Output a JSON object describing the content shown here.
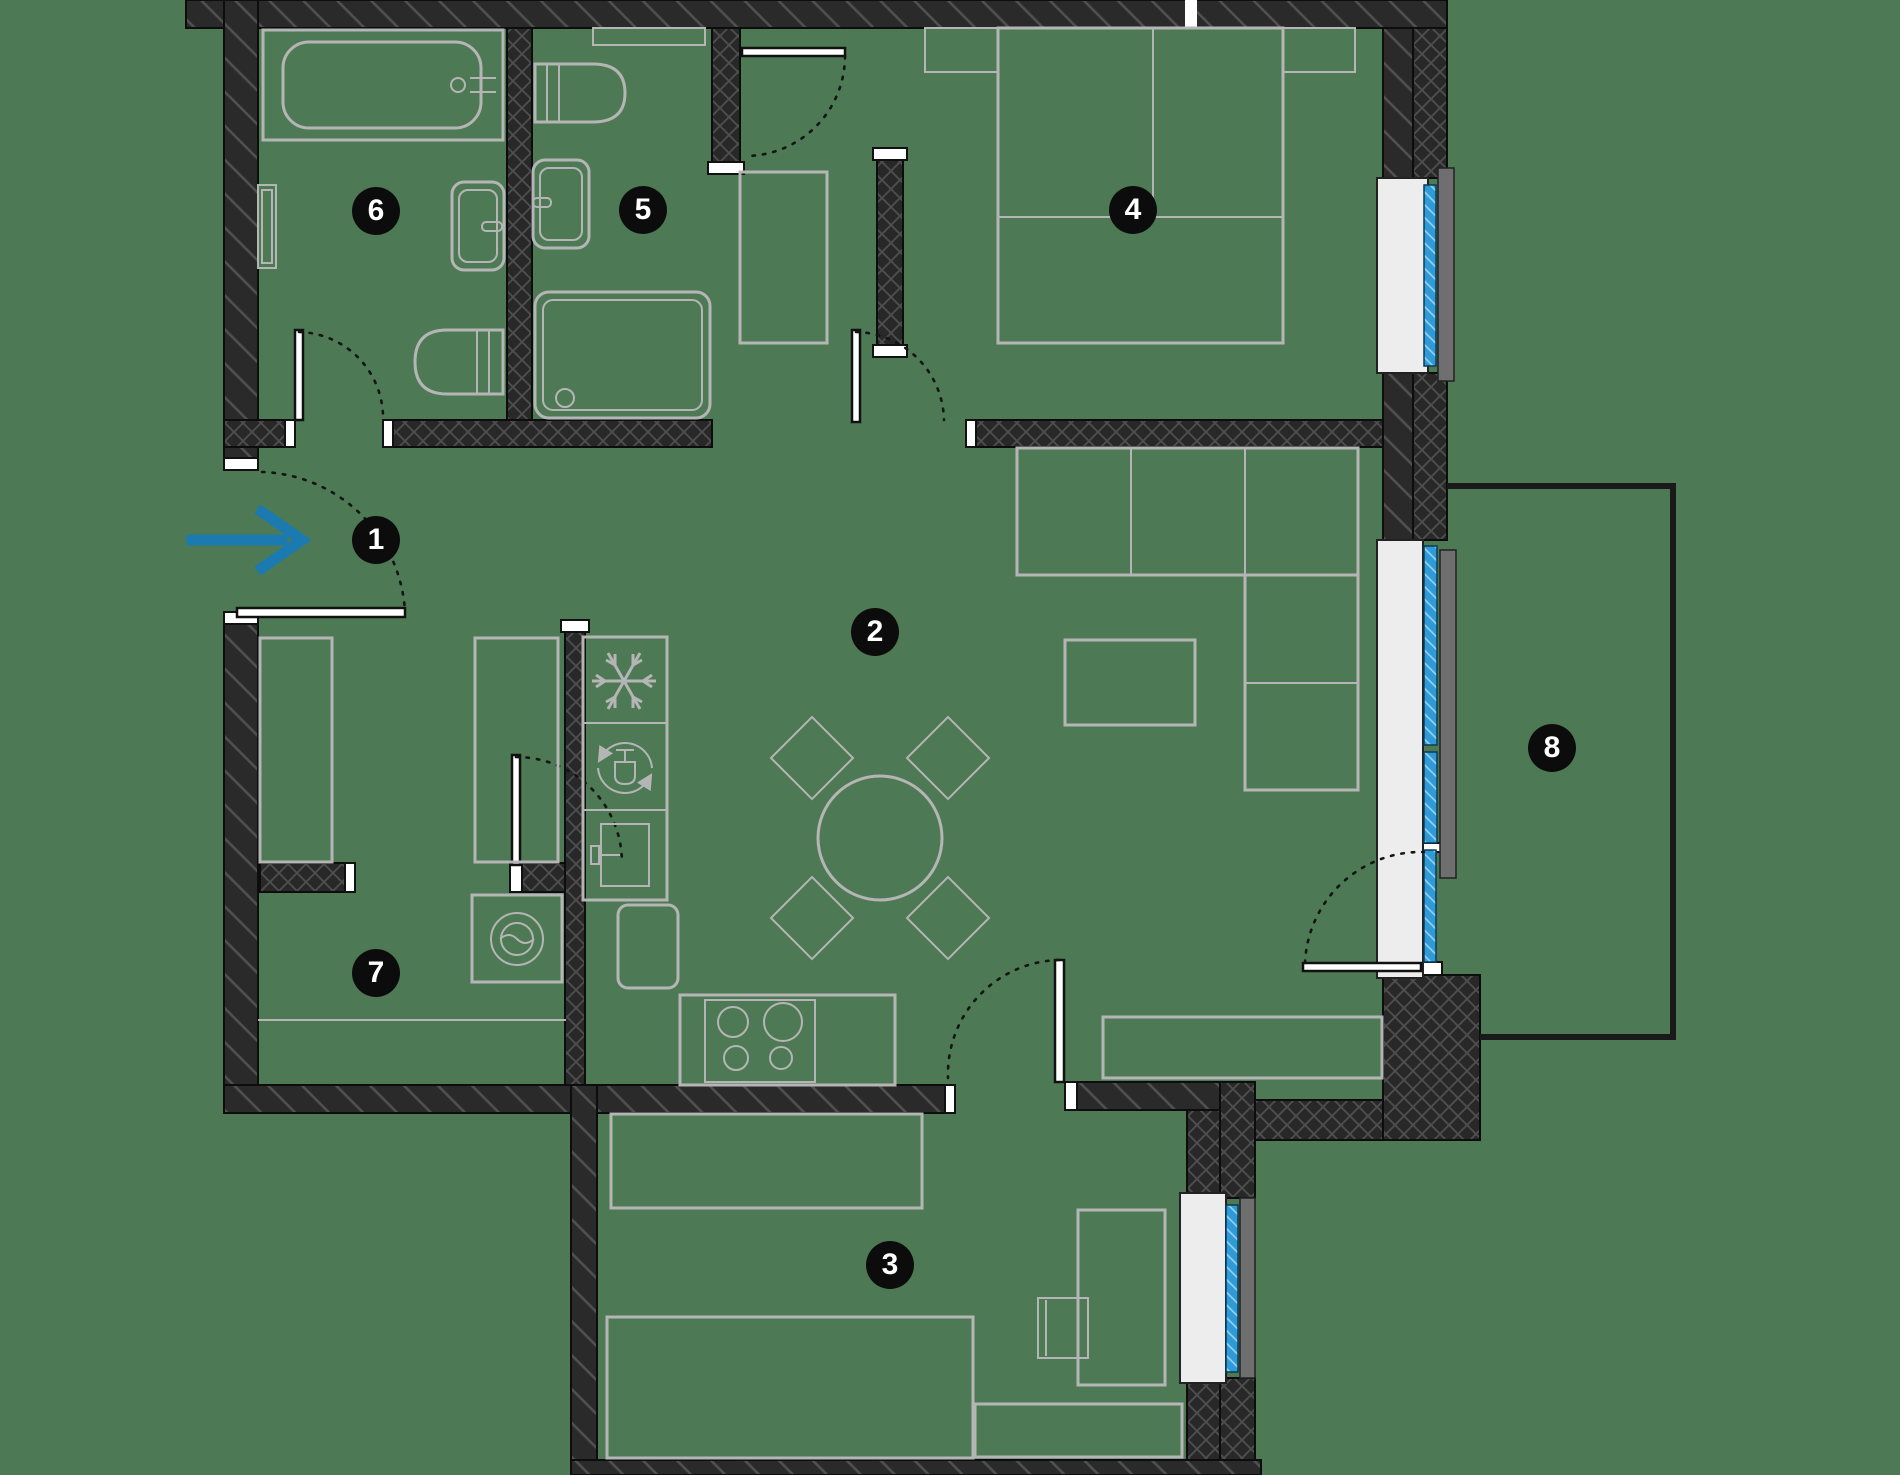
{
  "plan": {
    "badges": [
      {
        "number": "1"
      },
      {
        "number": "2"
      },
      {
        "number": "3"
      },
      {
        "number": "4"
      },
      {
        "number": "5"
      },
      {
        "number": "6"
      },
      {
        "number": "7"
      },
      {
        "number": "8"
      }
    ],
    "entrance": {
      "indicator": "arrow-right"
    },
    "colors": {
      "floor": "#4d7a54",
      "wall": "#2a2a2a",
      "wall_hatch": "#4f4f4f",
      "furniture_outline": "#b5b5b5",
      "window_glazing": "#2e9ad8",
      "window_sill": "#ededed",
      "window_ledge": "#6f6f6f",
      "entrance_arrow": "#1b7ab0",
      "badge_background": "#0c0c0c",
      "badge_text": "#ffffff"
    }
  }
}
